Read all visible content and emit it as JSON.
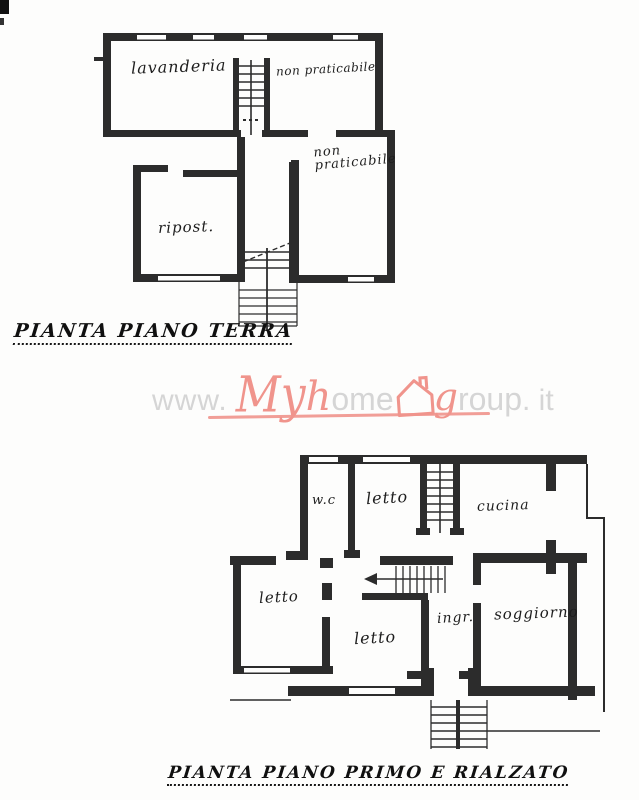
{
  "colors": {
    "ink": "#2c2c2c",
    "watermark_red": "#f0948c",
    "watermark_gray": "#d5d5d5"
  },
  "watermark": {
    "prefix": "www.",
    "brand": {
      "my": "My",
      "h": "h",
      "ome": "ome",
      "g": "g",
      "roup": "roup",
      "suffix": ". it"
    },
    "house_icon": "house-icon"
  },
  "plans": [
    {
      "id": "piano-terra",
      "title": "PIANTA PIANO TERRA",
      "rooms": [
        {
          "name": "lavanderia",
          "label": "lavanderia"
        },
        {
          "name": "non-praticabile-upper",
          "label": "non praticabile"
        },
        {
          "name": "non-praticabile-lower",
          "label_line1": "non",
          "label_line2": "praticabile"
        },
        {
          "name": "ripostiglio",
          "label": "ripost."
        }
      ]
    },
    {
      "id": "piano-primo-e-rialzato",
      "title": "PIANTA PIANO PRIMO E RIALZATO",
      "rooms": [
        {
          "name": "wc",
          "label": "w.c"
        },
        {
          "name": "letto-nord",
          "label": "letto"
        },
        {
          "name": "cucina",
          "label": "cucina"
        },
        {
          "name": "letto-ovest",
          "label": "letto"
        },
        {
          "name": "letto-centrale",
          "label": "letto"
        },
        {
          "name": "ingresso",
          "label": "ingr."
        },
        {
          "name": "soggiorno",
          "label": "soggiorno"
        }
      ]
    }
  ]
}
